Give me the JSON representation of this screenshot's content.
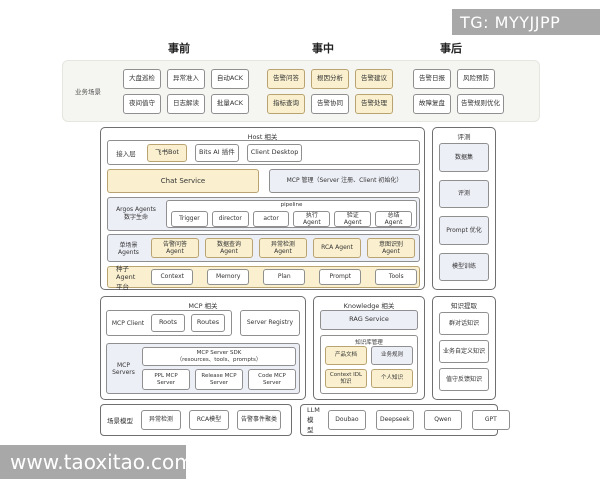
{
  "watermarks": {
    "tg_badge": "TG: MYYJJPP",
    "site_badge": "www.taoxitao.com"
  },
  "colors": {
    "accent_fill": "#faf0cf",
    "accent_border": "#b9a471",
    "panel_fill": "#edeff7",
    "badge_gray": "#a8a8a8"
  },
  "phase_headers": {
    "pre": "事前",
    "mid": "事中",
    "post": "事后"
  },
  "business": {
    "label": "业务场景",
    "pre_row1": [
      "大盘巡检",
      "异常准入",
      "自动ACK"
    ],
    "pre_row2": [
      "夜间值守",
      "日志解读",
      "批量ACK"
    ],
    "mid_row1": [
      {
        "label": "告警问答",
        "accent": true
      },
      {
        "label": "根因分析",
        "accent": true
      },
      {
        "label": "告警建议",
        "accent": true
      }
    ],
    "mid_row2": [
      {
        "label": "指标查询",
        "accent": true
      },
      "告警协同",
      {
        "label": "告警处理",
        "accent": true
      }
    ],
    "post_row1": [
      "告警日报",
      "风险预防"
    ],
    "post_row2": [
      "故障复盘",
      "告警规则优化"
    ]
  },
  "host": {
    "title": "Host 相关",
    "access_label": "接入层",
    "access_items": [
      {
        "label": "飞书Bot",
        "accent": true
      },
      "Bits AI 插件",
      "Client Desktop"
    ],
    "chat_service": "Chat Service",
    "mcp_mgmt": "MCP 管理（Server 注册、Client 初始化）",
    "argos_label_line1": "Argos Agents",
    "argos_label_line2": "数字生命",
    "pipeline_title": "pipeline",
    "pipeline_items": [
      "Trigger",
      "director",
      "actor",
      "执行Agent",
      "验证Agent",
      "总结Agent"
    ],
    "single_label": "单场景Agents",
    "single_items": [
      {
        "label": "告警问答Agent",
        "accent": true
      },
      {
        "label": "数据查询Agent",
        "accent": true
      },
      {
        "label": "异常检测Agent",
        "accent": true
      },
      {
        "label": "RCA Agent",
        "accent": true
      },
      {
        "label": "意图识别Agent",
        "accent": true
      }
    ],
    "seed_label": "种子Agent 平台",
    "seed_items": [
      "Context",
      "Memory",
      "Plan",
      "Prompt",
      "Tools"
    ]
  },
  "eval_panel": {
    "title": "评测",
    "items": [
      {
        "label": "数据集",
        "cls": "lav"
      },
      {
        "label": "评测",
        "cls": "lav"
      },
      {
        "label": "Prompt 优化",
        "cls": "lav"
      },
      {
        "label": "模型训练",
        "cls": "lav"
      }
    ]
  },
  "knowledge_extract": {
    "title": "知识提取",
    "items": [
      "群对话知识",
      "业务自定义知识",
      "值守反馈知识"
    ]
  },
  "mcp": {
    "title": "MCP 相关",
    "client_label": "MCP Client",
    "client_items": [
      "Roots",
      "Routes"
    ],
    "server_registry": "Server Registry",
    "servers_label": "MCP Servers",
    "sdk_line1": "MCP Server SDK",
    "sdk_line2": "（resources、tools、prompts）",
    "server_items": [
      "PPL MCP Server",
      "Release MCP Server",
      "Code MCP Server"
    ]
  },
  "knowledge": {
    "title": "Knowledge 相关",
    "rag": "RAG Service",
    "kb_title": "知识库管理",
    "kb_items": [
      {
        "label": "产品文档",
        "accent": true
      },
      {
        "label": "业务规则",
        "cls": "lav"
      },
      {
        "label": "Context IDL 知识",
        "accent": true
      },
      {
        "label": "个人知识",
        "accent": true
      }
    ]
  },
  "scene_models": {
    "label": "场景模型",
    "items": [
      "异常检测",
      "RCA模型",
      "告警事件聚类"
    ]
  },
  "llm_models": {
    "label": "LLM模型",
    "items": [
      "Doubao",
      "Deepseek",
      "Qwen",
      "GPT"
    ]
  }
}
